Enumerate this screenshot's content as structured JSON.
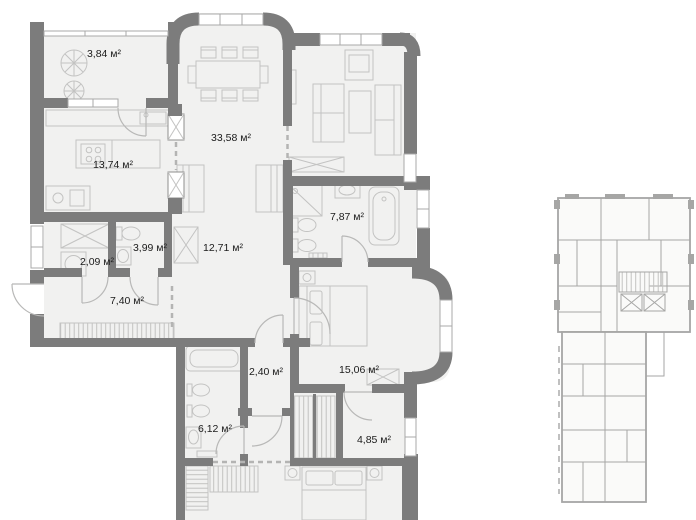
{
  "page": {
    "background": "#ffffff"
  },
  "plan": {
    "area_unit": "м²",
    "rooms": [
      {
        "id": "balcony",
        "area": "3,84 м²"
      },
      {
        "id": "kitchen",
        "area": "13,74 м²"
      },
      {
        "id": "living-dining",
        "area": "33,58 м²"
      },
      {
        "id": "bathroom-main",
        "area": "7,87 м²"
      },
      {
        "id": "wc",
        "area": "3,99 м²"
      },
      {
        "id": "hallway",
        "area": "12,71 м²"
      },
      {
        "id": "laundry",
        "area": "2,09 м²"
      },
      {
        "id": "entry-hall",
        "area": "7,40 м²"
      },
      {
        "id": "closet",
        "area": "2,40 м²"
      },
      {
        "id": "bedroom",
        "area": "15,06 м²"
      },
      {
        "id": "bathroom-second",
        "area": "6,12 м²"
      },
      {
        "id": "dressing-room",
        "area": "4,85 м²"
      }
    ],
    "colors": {
      "wall": "#7c7c7c",
      "floor": "#f1f1f0",
      "furniture": "#c3c3c2",
      "door": "#b8b8b7",
      "window": "#a9a9a8",
      "label": "#1b1b1b",
      "miniplan": "#a6a6a5"
    }
  }
}
